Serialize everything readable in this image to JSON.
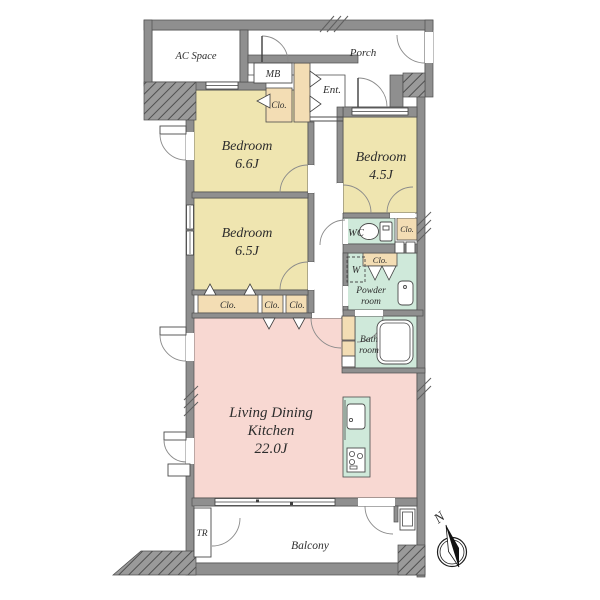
{
  "plan": {
    "rooms": {
      "bedroom_66": {
        "label": "Bedroom",
        "size": "6.6J"
      },
      "bedroom_45": {
        "label": "Bedroom",
        "size": "4.5J"
      },
      "bedroom_65": {
        "label": "Bedroom",
        "size": "6.5J"
      },
      "ldk": {
        "line1": "Living Dining",
        "line2": "Kitchen",
        "size": "22.0J"
      },
      "wc": {
        "label": "WC"
      },
      "powder": {
        "line1": "Powder",
        "line2": "room"
      },
      "bath": {
        "line1": "Bath",
        "line2": "room"
      },
      "entrance": {
        "label": "Ent."
      },
      "porch": {
        "label": "Porch"
      },
      "ac_space": {
        "label": "AC Space"
      },
      "meter_box": {
        "label": "MB"
      },
      "balcony": {
        "label": "Balcony"
      },
      "trunk_room": {
        "label": "TR"
      },
      "washer": {
        "label": "W"
      },
      "closet": {
        "label": "Clo."
      }
    },
    "compass": {
      "north": "N"
    },
    "colors": {
      "bedroom": "#efe5b0",
      "ldk": "#f8d8d2",
      "wet_area": "#cfe9da",
      "closet": "#f3ddb4",
      "wall": "#8f8f8f",
      "hatch_wall": "#9a9a9a"
    }
  }
}
